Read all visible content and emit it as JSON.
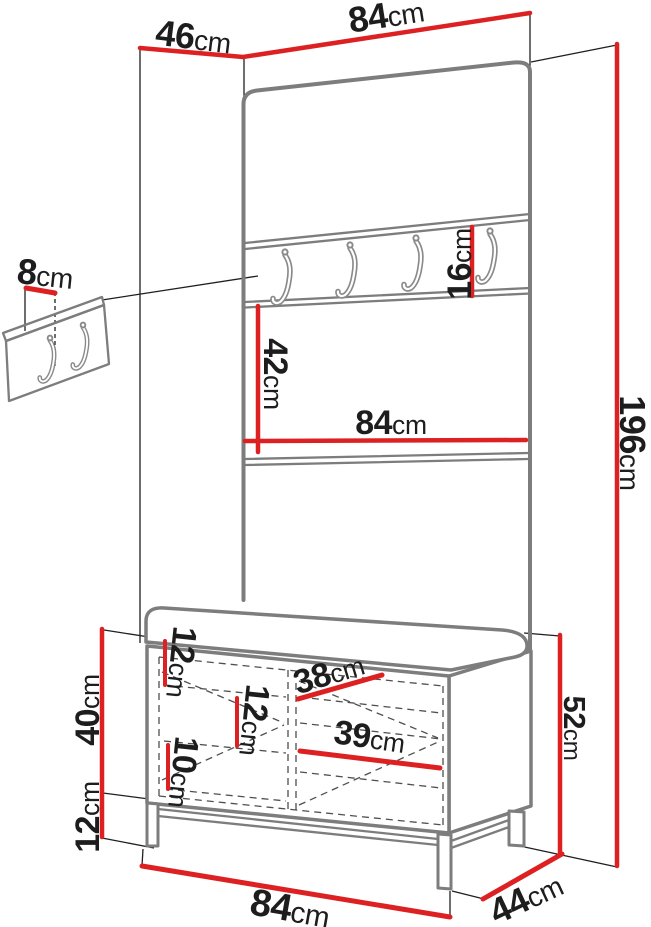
{
  "diagram": {
    "title": "Hallway furniture set dimension diagram",
    "type": "furniture-dimension-diagram",
    "subject": "wardrobe panel with coat hooks, shoe bench and wall hook panel",
    "colors": {
      "dimension_red": "#dd2021",
      "line_black": "#1f1f1f",
      "furniture_gray": "#7d7d7d",
      "hook_gray": "#8a8a8a",
      "dashed_gray": "#4f4f4f",
      "text": "#1d1d1d",
      "background": "#ffffff"
    },
    "labels": {
      "top_width": {
        "value": "84",
        "unit": "cm"
      },
      "top_depth": {
        "value": "46",
        "unit": "cm"
      },
      "wall_hook_panel": {
        "value": "8",
        "unit": "cm"
      },
      "hook_strip_height": {
        "value": "16",
        "unit": "cm"
      },
      "mid_panel_height": {
        "value": "42",
        "unit": "cm"
      },
      "mid_panel_width": {
        "value": "84",
        "unit": "cm"
      },
      "total_height": {
        "value": "196",
        "unit": "cm"
      },
      "bench_body_height": {
        "value": "40",
        "unit": "cm"
      },
      "leg_height": {
        "value": "12",
        "unit": "cm"
      },
      "shelf_gap_top": {
        "value": "12",
        "unit": "cm"
      },
      "shelf_gap_middle": {
        "value": "12",
        "unit": "cm"
      },
      "shelf_gap_bottom": {
        "value": "10",
        "unit": "cm"
      },
      "left_compartment_width": {
        "value": "38",
        "unit": "cm"
      },
      "right_compartment_width": {
        "value": "39",
        "unit": "cm"
      },
      "bench_height": {
        "value": "52",
        "unit": "cm"
      },
      "bottom_width": {
        "value": "84",
        "unit": "cm"
      },
      "bottom_depth": {
        "value": "44",
        "unit": "cm"
      }
    },
    "icons": {
      "rail_hook_count": 4,
      "wall_panel_hook_count": 2
    }
  }
}
